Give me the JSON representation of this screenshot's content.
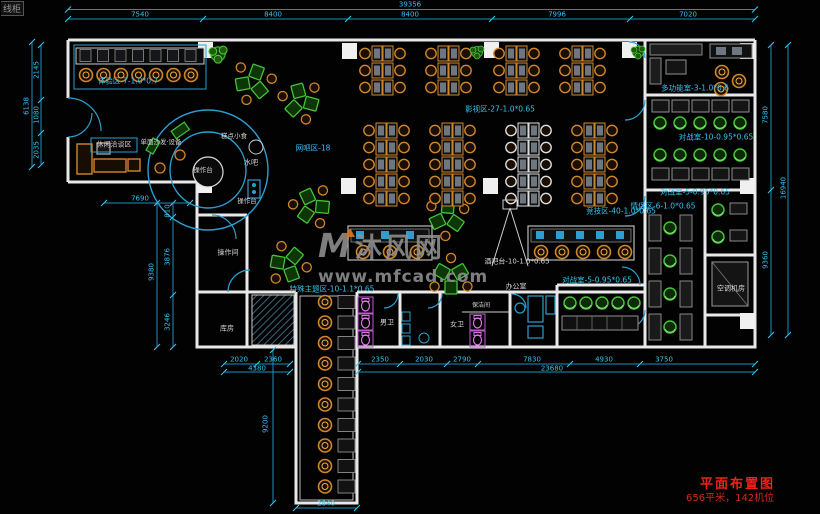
{
  "meta": {
    "corner_note": "线柜"
  },
  "title_block": {
    "title": "平面布置图",
    "subtitle": "656平米，142机位"
  },
  "watermark": {
    "logo_letter": "M",
    "logo_text": "沐风网",
    "url": "www.mfcad.com"
  },
  "zones": {
    "experience": "体验区-7-1.0*0.7",
    "leisure": "休闲洽谈区",
    "sofa_note": "单面沙发·设备",
    "snack": "糕点小食",
    "water_bar": "水吧",
    "counter_a": "操作台",
    "counter_b": "操作台",
    "net_area": "网吧区-18",
    "movie": "影视区-27-1.0*0.65",
    "esports": "竞技区-40-1.0*0.65",
    "bar_seats": "酒吧台-10-1.0*0.65",
    "office": "办公室",
    "battle_center": "对战室-5-0.95*0.65",
    "multi_room": "多功能室-3-1.0*0.6",
    "battle_10": "对战室-10-0.95*0.65",
    "battle_5": "对战室-5-0.95*0.65",
    "couple": "情侣区-6-1.0*0.65",
    "ac_room": "空调机房",
    "special": "特殊主题区-10-1.1*0.65",
    "male_wc": "男卫",
    "female_wc": "女卫",
    "cleaning": "保洁间",
    "op_room": "操作间",
    "storage": "库房"
  },
  "dims": {
    "top_total": "39356",
    "top": [
      "7540",
      "8400",
      "8400",
      "7996",
      "7020"
    ],
    "left_total": "6138",
    "left": [
      "2145",
      "1080",
      "2035"
    ],
    "left_mid_width": "7690",
    "left_mid_total": "9380",
    "left_mid": [
      "810",
      "3876",
      "3246"
    ],
    "right_total": "16940",
    "right": [
      "7580",
      "9360"
    ],
    "bottom_left_total": "4380",
    "bottom_left": [
      "2020",
      "2360"
    ],
    "bottom_right_total": "23680",
    "bottom_right": [
      "2350",
      "2030",
      "2790",
      "7830",
      "4930",
      "3750"
    ],
    "corridor_height": "9200",
    "corridor_width": "2840"
  },
  "colors": {
    "background": "#020202",
    "wall": "#e8e8e8",
    "dimension_cyan": "#35c3f0",
    "furniture_orange": "#d0862a",
    "furniture_green": "#46c13a",
    "toilet_magenta": "#c05ad0",
    "title_red": "#ee2418",
    "watermark_grey": "#909090"
  }
}
